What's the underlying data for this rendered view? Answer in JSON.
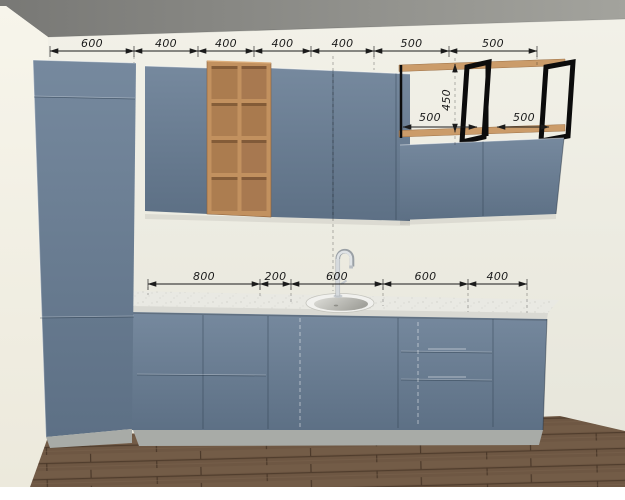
{
  "colors": {
    "cabinet_blue": "#6b7e93",
    "cabinet_blue_dark": "#5d7085",
    "wood_shelf": "#c2915f",
    "wood_compartment": "#ab7c4f",
    "wood_rail": "#cb9c6a",
    "frame_black": "#0c0c0c",
    "countertop": "#e9e9e3",
    "counter_edge": "#d9d9d3",
    "plinth_gray": "#a8aba7",
    "wall_back": "#efeee5",
    "wall_left": "#f5f3e9",
    "ceiling_gray": "#8c8c88",
    "floor_brown": "#6e5743",
    "sink_white": "#f1f1ee",
    "dimension_ink": "#1b1b1b"
  },
  "dimensions": {
    "upper_row": [
      "600",
      "400",
      "400",
      "400",
      "400",
      "500",
      "500"
    ],
    "base_row": [
      "800",
      "200",
      "600",
      "600",
      "400"
    ],
    "shelf_section": {
      "left_width": "500",
      "height": "450",
      "right_width": "500"
    }
  }
}
